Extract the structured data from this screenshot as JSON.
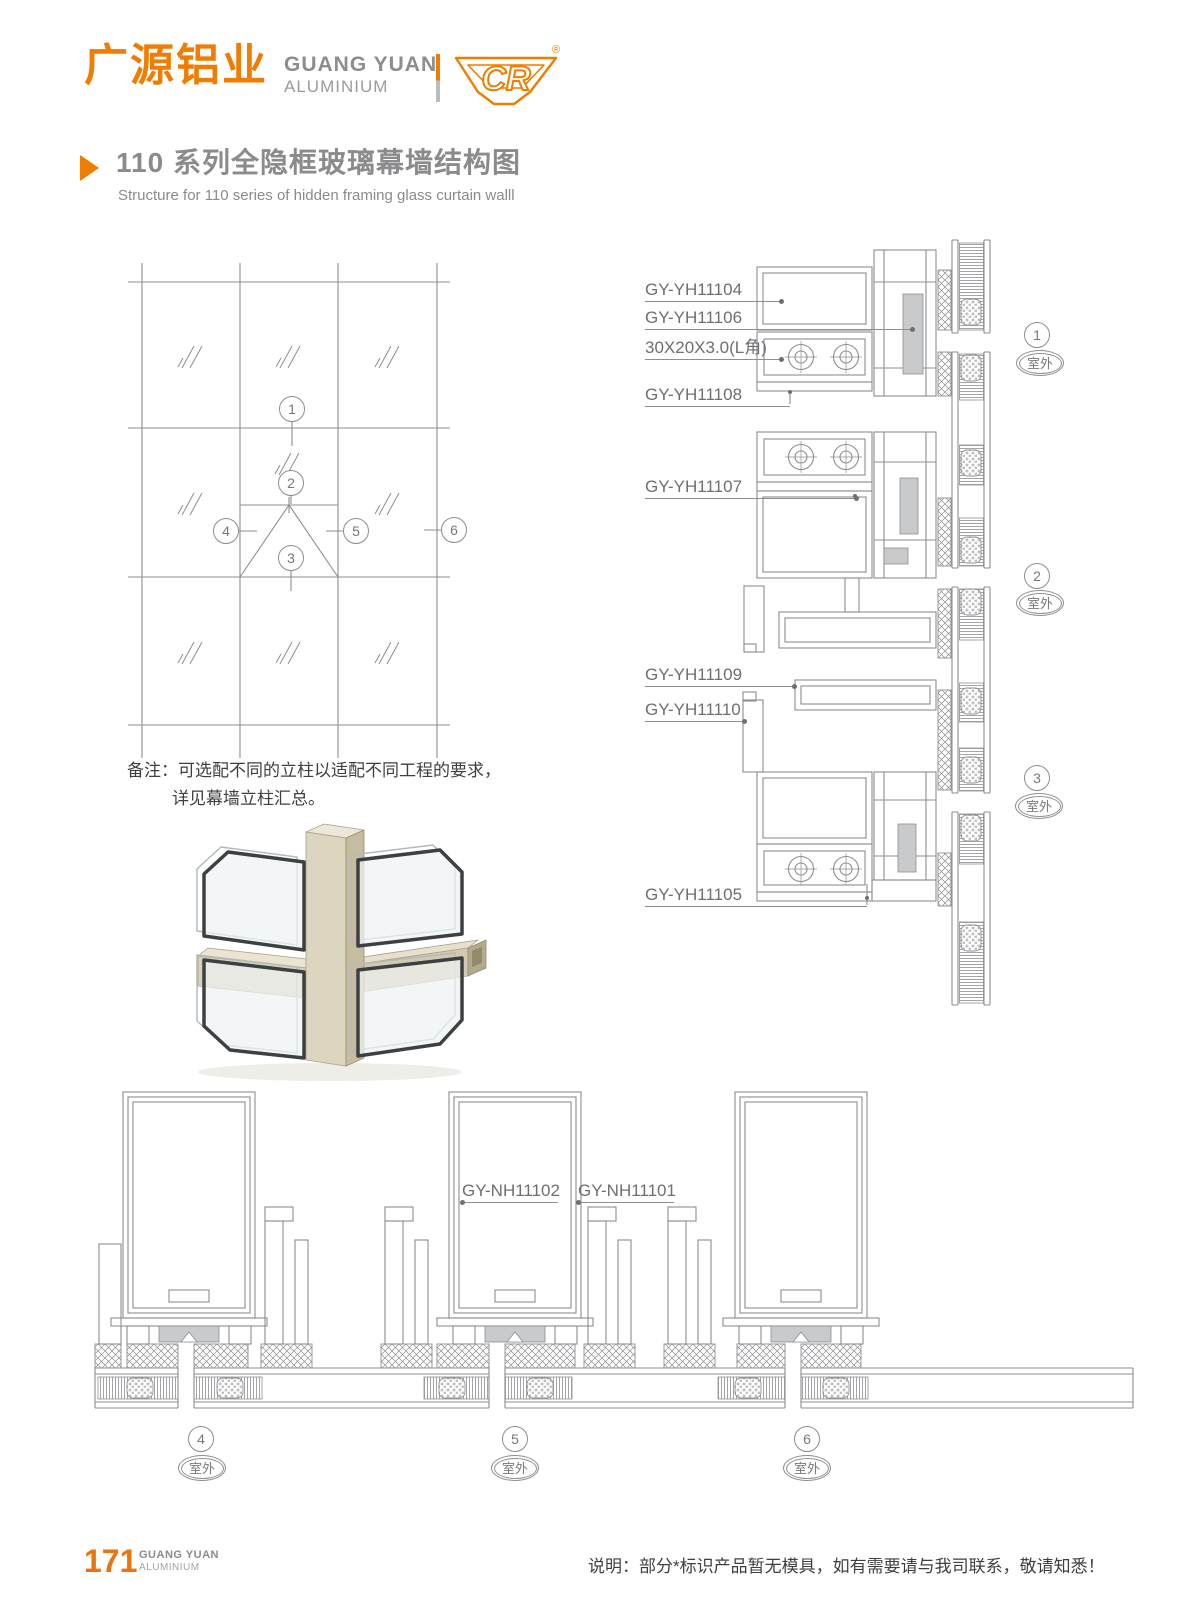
{
  "header": {
    "logo_cn": "广源铝业",
    "logo_en_line1": "GUANG YUAN",
    "logo_en_line2": "ALUMINIUM",
    "logo_mark_text": "CR",
    "registered_mark": "®"
  },
  "title": {
    "cn": "110 系列全隐框玻璃幕墙结构图",
    "en": "Structure for 110 series of hidden framing glass curtain walll"
  },
  "elevation": {
    "callouts": [
      "1",
      "2",
      "3",
      "4",
      "5",
      "6"
    ]
  },
  "note": {
    "line1": "备注：可选配不同的立柱以适配不同工程的要求，",
    "line2": "详见幕墙立柱汇总。"
  },
  "vertical_details": {
    "labels": [
      "GY-YH11104",
      "GY-YH11106",
      "30X20X3.0(L角)",
      "GY-YH11108",
      "GY-YH11107",
      "GY-YH11109",
      "GY-YH11110",
      "GY-YH11105"
    ],
    "marks": [
      {
        "num": "1",
        "outdoor": "室外"
      },
      {
        "num": "2",
        "outdoor": "室外"
      },
      {
        "num": "3",
        "outdoor": "室外"
      }
    ]
  },
  "horizontal_details": {
    "labels": [
      "GY-NH11102",
      "GY-NH11101"
    ],
    "marks": [
      {
        "num": "4",
        "outdoor": "室外"
      },
      {
        "num": "5",
        "outdoor": "室外"
      },
      {
        "num": "6",
        "outdoor": "室外"
      }
    ]
  },
  "footer": {
    "page_number": "171",
    "brand_line1": "GUANG YUAN",
    "brand_line2": "ALUMINIUM",
    "note": "说明：部分*标识产品暂无模具，如有需要请与我司联系，敬请知悉！"
  },
  "colors": {
    "accent_orange": "#ef7d00",
    "line_gray": "#8d8e92",
    "text_dark": "#3f3f42"
  }
}
